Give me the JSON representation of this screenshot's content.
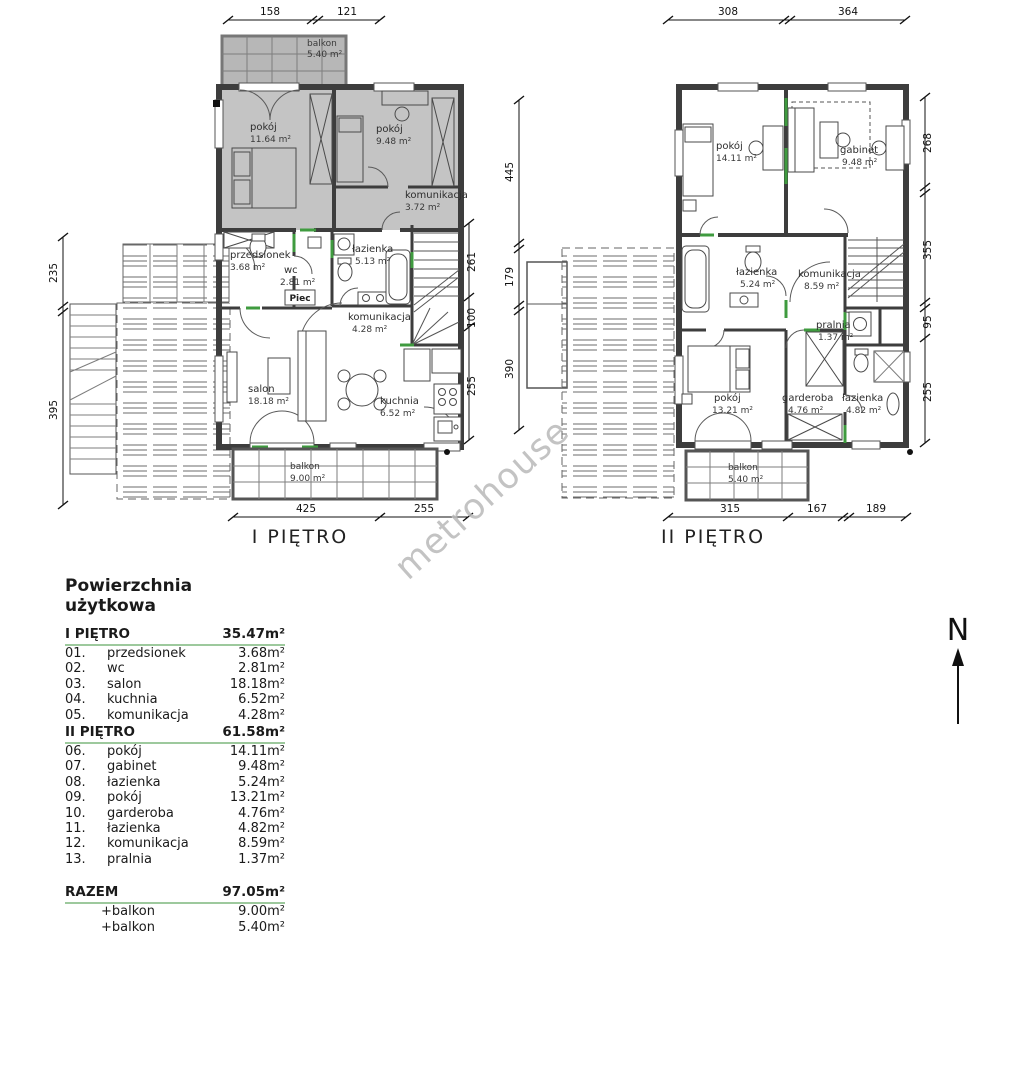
{
  "watermark": "metrohouse",
  "north": {
    "label": "N"
  },
  "plan1": {
    "title": "I PIĘTRO",
    "dims": {
      "top": [
        "158",
        "121"
      ],
      "left": [
        "235",
        "395"
      ],
      "right": [
        "261",
        "100",
        "255"
      ],
      "bottom": [
        "425",
        "255"
      ]
    },
    "rooms": {
      "balkon_top": {
        "name": "balkon",
        "area": "5.40 m²"
      },
      "pokoj_1": {
        "name": "pokój",
        "area": "11.64 m²"
      },
      "pokoj_2": {
        "name": "pokój",
        "area": "9.48 m²"
      },
      "komunikacja1": {
        "name": "komunikacja",
        "area": "3.72 m²"
      },
      "przedsionek": {
        "name": "przedsionek",
        "area": "3.68 m²"
      },
      "wc": {
        "name": "wc",
        "area": "2.81 m²"
      },
      "lazienka": {
        "name": "łazienka",
        "area": "5.13 m²"
      },
      "piec": {
        "name": "Piec"
      },
      "komunikacja2": {
        "name": "komunikacja",
        "area": "4.28 m²"
      },
      "salon": {
        "name": "salon",
        "area": "18.18 m²"
      },
      "kuchnia": {
        "name": "kuchnia",
        "area": "6.52 m²"
      },
      "balkon_dol": {
        "name": "balkon",
        "area": "9.00 m²"
      }
    }
  },
  "plan2": {
    "title": "II PIĘTRO",
    "dims": {
      "top": [
        "308",
        "364"
      ],
      "left": [
        "445",
        "179",
        "390"
      ],
      "right": [
        "268",
        "355",
        "95",
        "255"
      ],
      "bottom": [
        "315",
        "167",
        "189"
      ]
    },
    "rooms": {
      "pokoj_1": {
        "name": "pokój",
        "area": "14.11 m²"
      },
      "gabinet": {
        "name": "gabinet",
        "area": "9.48 m²"
      },
      "lazienka_gora": {
        "name": "łazienka",
        "area": "5.24 m²"
      },
      "komunikacja": {
        "name": "komunikacja",
        "area": "8.59 m²"
      },
      "pralnia": {
        "name": "pralnia",
        "area": "1.37 m²"
      },
      "pokoj_2": {
        "name": "pokój",
        "area": "13.21 m²"
      },
      "garderoba": {
        "name": "garderoba",
        "area": "4.76 m²"
      },
      "lazienka_dol": {
        "name": "łazienka",
        "area": "4.82 m²"
      },
      "balkon": {
        "name": "balkon",
        "area": "5.40 m²"
      }
    }
  },
  "legend": {
    "title": "Powierzchnia użytkowa",
    "sections": [
      {
        "label": "I PIĘTRO",
        "total": "35.47m²"
      },
      {
        "label": "II PIĘTRO",
        "total": "61.58m²"
      },
      {
        "label": "RAZEM",
        "total": "97.05m²"
      }
    ],
    "floor1_rows": [
      {
        "num": "01.",
        "name": "przedsionek",
        "area": "3.68m²"
      },
      {
        "num": "02.",
        "name": "wc",
        "area": "2.81m²"
      },
      {
        "num": "03.",
        "name": "salon",
        "area": "18.18m²"
      },
      {
        "num": "04.",
        "name": "kuchnia",
        "area": "6.52m²"
      },
      {
        "num": "05.",
        "name": "komunikacja",
        "area": "4.28m²"
      }
    ],
    "floor2_rows": [
      {
        "num": "06.",
        "name": "pokój",
        "area": "14.11m²"
      },
      {
        "num": "07.",
        "name": "gabinet",
        "area": "9.48m²"
      },
      {
        "num": "08.",
        "name": "łazienka",
        "area": "5.24m²"
      },
      {
        "num": "09.",
        "name": "pokój",
        "area": "13.21m²"
      },
      {
        "num": "10.",
        "name": "garderoba",
        "area": "4.76m²"
      },
      {
        "num": "11.",
        "name": "łazienka",
        "area": "4.82m²"
      },
      {
        "num": "12.",
        "name": "komunikacja",
        "area": "8.59m²"
      },
      {
        "num": "13.",
        "name": "pralnia",
        "area": "1.37m²"
      }
    ],
    "extras": [
      {
        "name": "+balkon",
        "area": "9.00m²"
      },
      {
        "name": "+balkon",
        "area": "5.40m²"
      }
    ]
  },
  "colors": {
    "wall": "#3d3d3d",
    "room_gray": "#c4c4c4",
    "accent_green": "#3f9b3f",
    "legend_line_green": "#9dc99d",
    "watermark_gray": "#b9b9b9"
  }
}
